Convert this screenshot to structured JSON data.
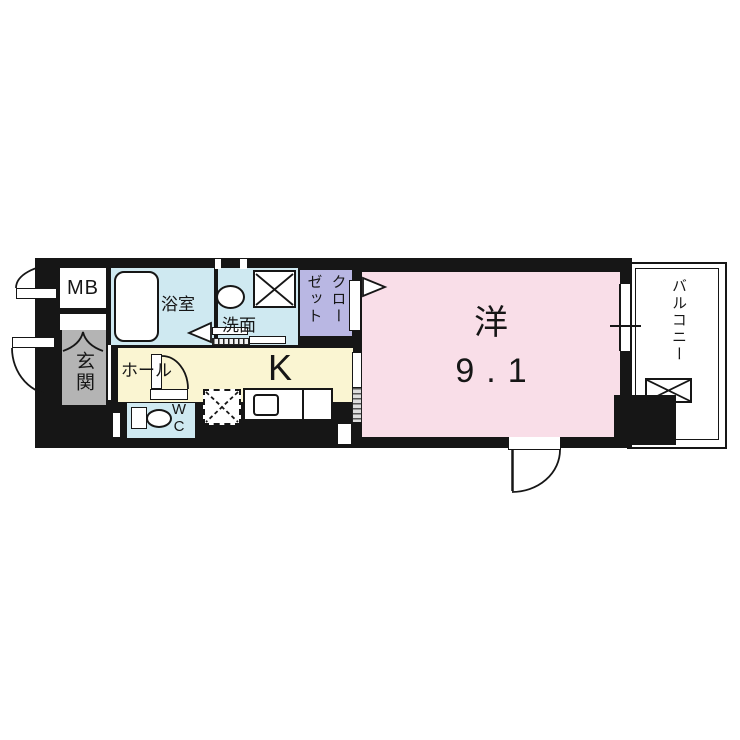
{
  "rooms": {
    "mb": {
      "label": "MB"
    },
    "genkan": {
      "label": "玄関"
    },
    "bathroom": {
      "label": "浴室"
    },
    "washroom": {
      "label": "洗面"
    },
    "closet": {
      "label": "クローゼット",
      "label_columns": [
        "クロー",
        "ゼット"
      ]
    },
    "hall": {
      "label": "ホール"
    },
    "kitchen": {
      "label": "K"
    },
    "wc": {
      "label": "WC",
      "label_lines": [
        "W",
        "C"
      ]
    },
    "western": {
      "label": "洋",
      "size": "9.1"
    },
    "balcony": {
      "label": "バルコニー"
    }
  },
  "colors": {
    "wall": "#161616",
    "room_pink": "#f9dee8",
    "room_yellow": "#faf5d2",
    "room_blue": "#cfe9f1",
    "room_lavender": "#b9b7e3",
    "room_gray": "#b4b4b4",
    "floor_white": "#ffffff"
  }
}
